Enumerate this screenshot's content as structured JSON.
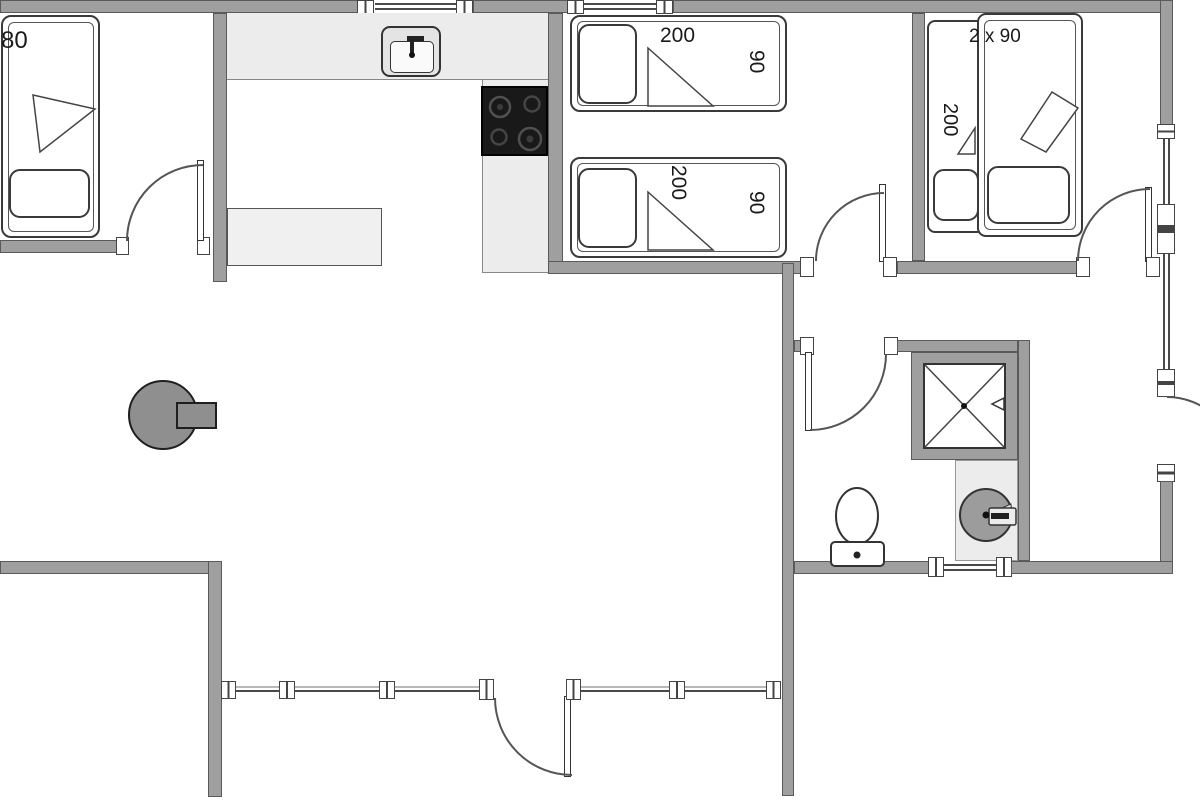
{
  "labels": {
    "bedroom1_bed_width": "80",
    "bedroom2_bed1_length": "200",
    "bedroom2_bed1_width": "90",
    "bedroom2_bed2_length": "200",
    "bedroom2_bed2_width": "90",
    "bedroom3_bed_size": "2 x 90",
    "bedroom3_bed_length": "200"
  },
  "colors": {
    "wall": "#9f9f9f",
    "wall_outline": "#5a5a5a",
    "counter": "#ececec",
    "stove_top": "#191919",
    "wood_stove": "#8f8f8f",
    "line": "#444444"
  }
}
